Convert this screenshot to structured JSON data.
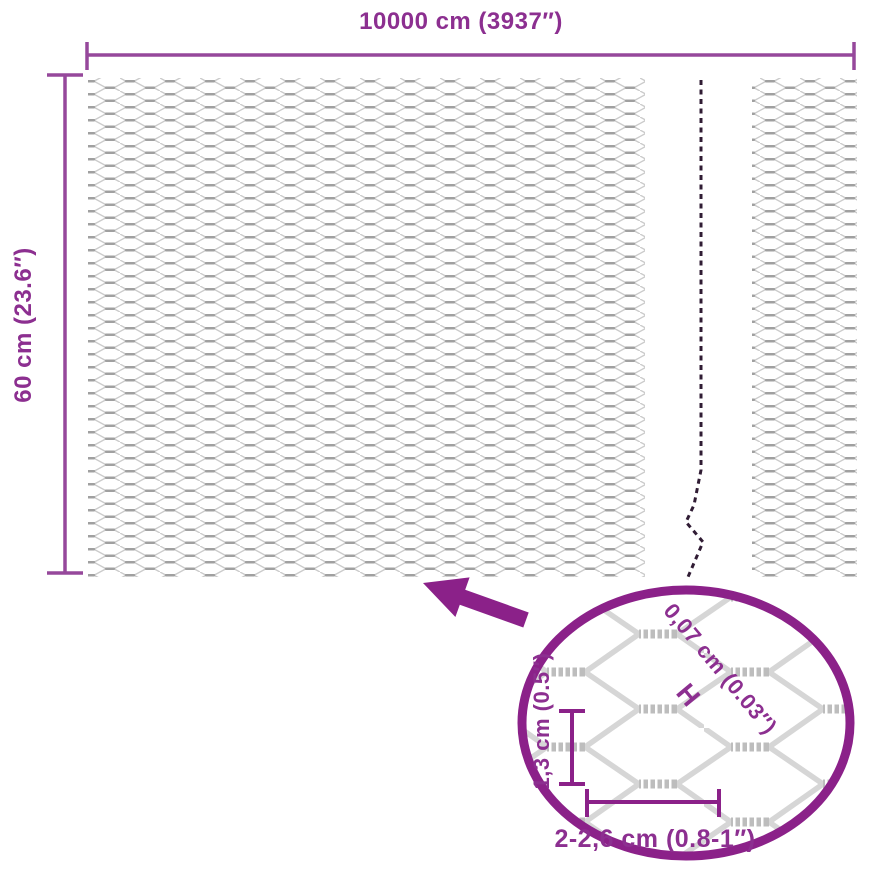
{
  "dimensions": {
    "width_label": "10000 cm (3937″)",
    "height_label": "60 cm (23.6″)"
  },
  "detail_view": {
    "wire_thickness_label": "0,07 cm (0.03″)",
    "thickness_marker": "H",
    "cell_height_label": "1,3 cm (0.5″)",
    "cell_width_label": "2-2,6 cm (0.8-1″)"
  },
  "colors": {
    "accent": "#8b2189",
    "dimension_line": "#96489b",
    "label_text": "#8c2f90",
    "break_line": "#301c34",
    "mesh_wire_light": "#cbcbcb",
    "mesh_wire_dark": "#a0a0a0"
  }
}
